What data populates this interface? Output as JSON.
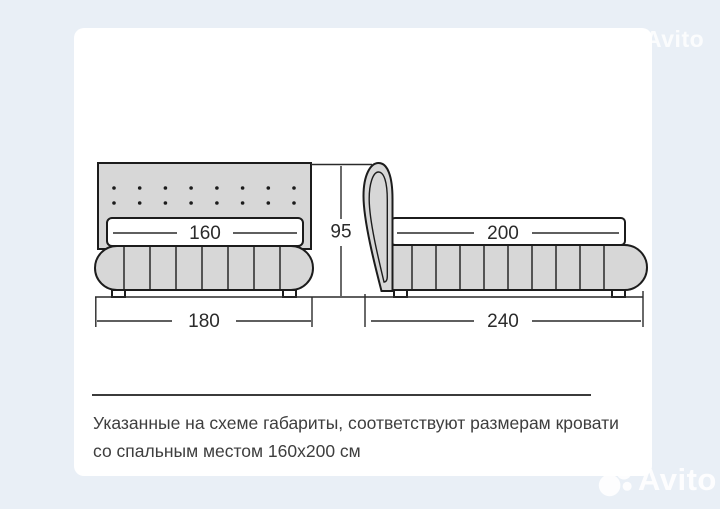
{
  "diagram": {
    "front_view_labels": {
      "sleeping_width": "160",
      "overall_width": "180",
      "height": "95"
    },
    "side_view_labels": {
      "sleeping_length": "200",
      "overall_length": "240"
    }
  },
  "caption": {
    "line1": "Указанные на схеме габариты, соответствуют размерам кровати",
    "line2": "со спальным местом 160x200 см"
  },
  "watermark": {
    "brand": "Avito"
  },
  "colors": {
    "background": "#e9eff6",
    "card": "#ffffff",
    "upholstery_fill": "#d7d7d7",
    "outline": "#1c1c1c",
    "watermark": "#ffffff"
  }
}
